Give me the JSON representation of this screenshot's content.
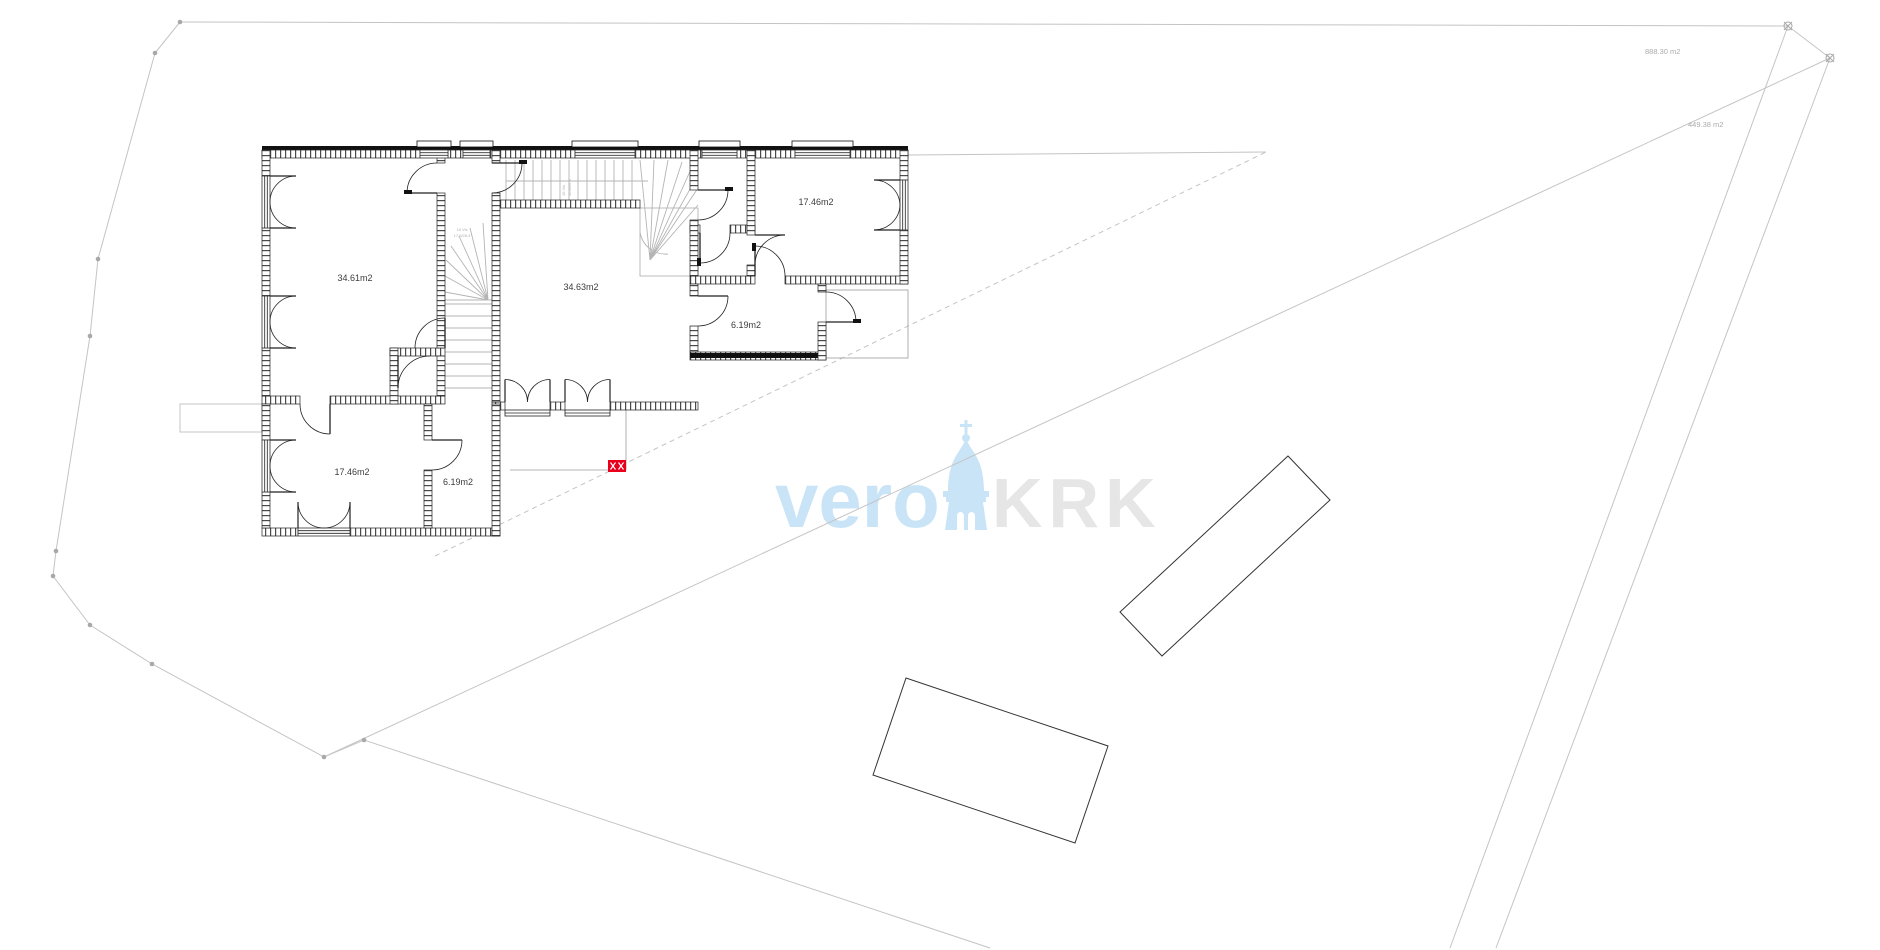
{
  "page": {
    "background": "#ffffff",
    "kind": "architectural site and floor plan drawing"
  },
  "floor_plan": {
    "rooms": [
      {
        "name": "room-left-large",
        "area_label": "34.61m2"
      },
      {
        "name": "room-center-large",
        "area_label": "34.63m2"
      },
      {
        "name": "room-right-top",
        "area_label": "17.46m2"
      },
      {
        "name": "room-right-small",
        "area_label": "6.19m2"
      },
      {
        "name": "room-bottom-left",
        "area_label": "17.46m2"
      },
      {
        "name": "room-bottom-small",
        "area_label": "6.19m2"
      }
    ],
    "stair_labels": [
      {
        "line1": "16 Vis",
        "line2": "17.9/28.4"
      },
      {
        "line1": "16 Vis",
        "line2": "16.8/26.9"
      }
    ],
    "ink_color": "#1c1c1c",
    "stair_color": "#b4b4b4"
  },
  "site": {
    "parcel_area_labels": [
      {
        "text": "888.30 m2"
      },
      {
        "text": "449.38 m2"
      }
    ],
    "line_color": "#c4c4c4",
    "dot_color": "#a8a8a8"
  },
  "watermark": {
    "word_left": "vero",
    "word_right": "KRK",
    "icon": "bell-tower-icon",
    "color_blue": "#c9e4f6",
    "color_gray": "#e6e6e6"
  },
  "markers": {
    "utility_marker_color": "#e8001d"
  }
}
